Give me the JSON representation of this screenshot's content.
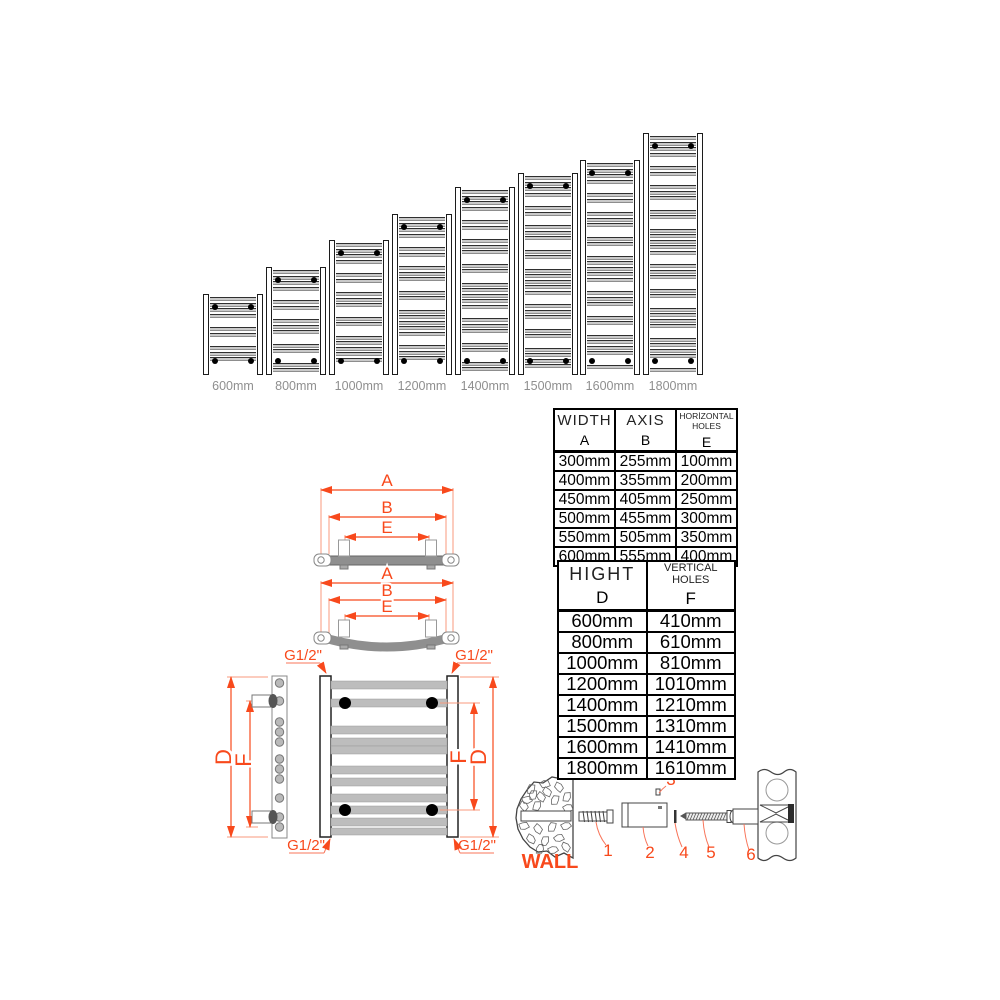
{
  "radiators": {
    "sizes": [
      "600mm",
      "800mm",
      "1000mm",
      "1200mm",
      "1400mm",
      "1500mm",
      "1600mm",
      "1800mm"
    ]
  },
  "size_table": {
    "columns": [
      {
        "title": "WIDTH",
        "letter": "A"
      },
      {
        "title": "AXIS",
        "letter": "B"
      },
      {
        "title": "HORİZONTAL HOLES",
        "letter": "E"
      }
    ],
    "rows": [
      [
        "300mm",
        "255mm",
        "100mm"
      ],
      [
        "400mm",
        "355mm",
        "200mm"
      ],
      [
        "450mm",
        "405mm",
        "250mm"
      ],
      [
        "500mm",
        "455mm",
        "300mm"
      ],
      [
        "550mm",
        "505mm",
        "350mm"
      ],
      [
        "600mm",
        "555mm",
        "400mm"
      ]
    ]
  },
  "height_table": {
    "columns": [
      {
        "title": "HIGHT",
        "letter": "D"
      },
      {
        "title": "VERTICAL HOLES",
        "letter": "F"
      }
    ],
    "rows": [
      [
        "600mm",
        "410mm"
      ],
      [
        "800mm",
        "610mm"
      ],
      [
        "1000mm",
        "810mm"
      ],
      [
        "1200mm",
        "1010mm"
      ],
      [
        "1400mm",
        "1210mm"
      ],
      [
        "1500mm",
        "1310mm"
      ],
      [
        "1600mm",
        "1410mm"
      ],
      [
        "1800mm",
        "1610mm"
      ]
    ]
  },
  "dimensions": {
    "a": "A",
    "b": "B",
    "e": "E",
    "d": "D",
    "f": "F",
    "thread": "G1/2\""
  },
  "wall_diagram": {
    "wall_label": "WALL",
    "parts": [
      "1",
      "2",
      "3",
      "4",
      "5",
      "6"
    ]
  },
  "colors": {
    "accent": "#F8491C",
    "bar_gray": "#B9B9B9",
    "label_gray": "#8F8F8F"
  }
}
